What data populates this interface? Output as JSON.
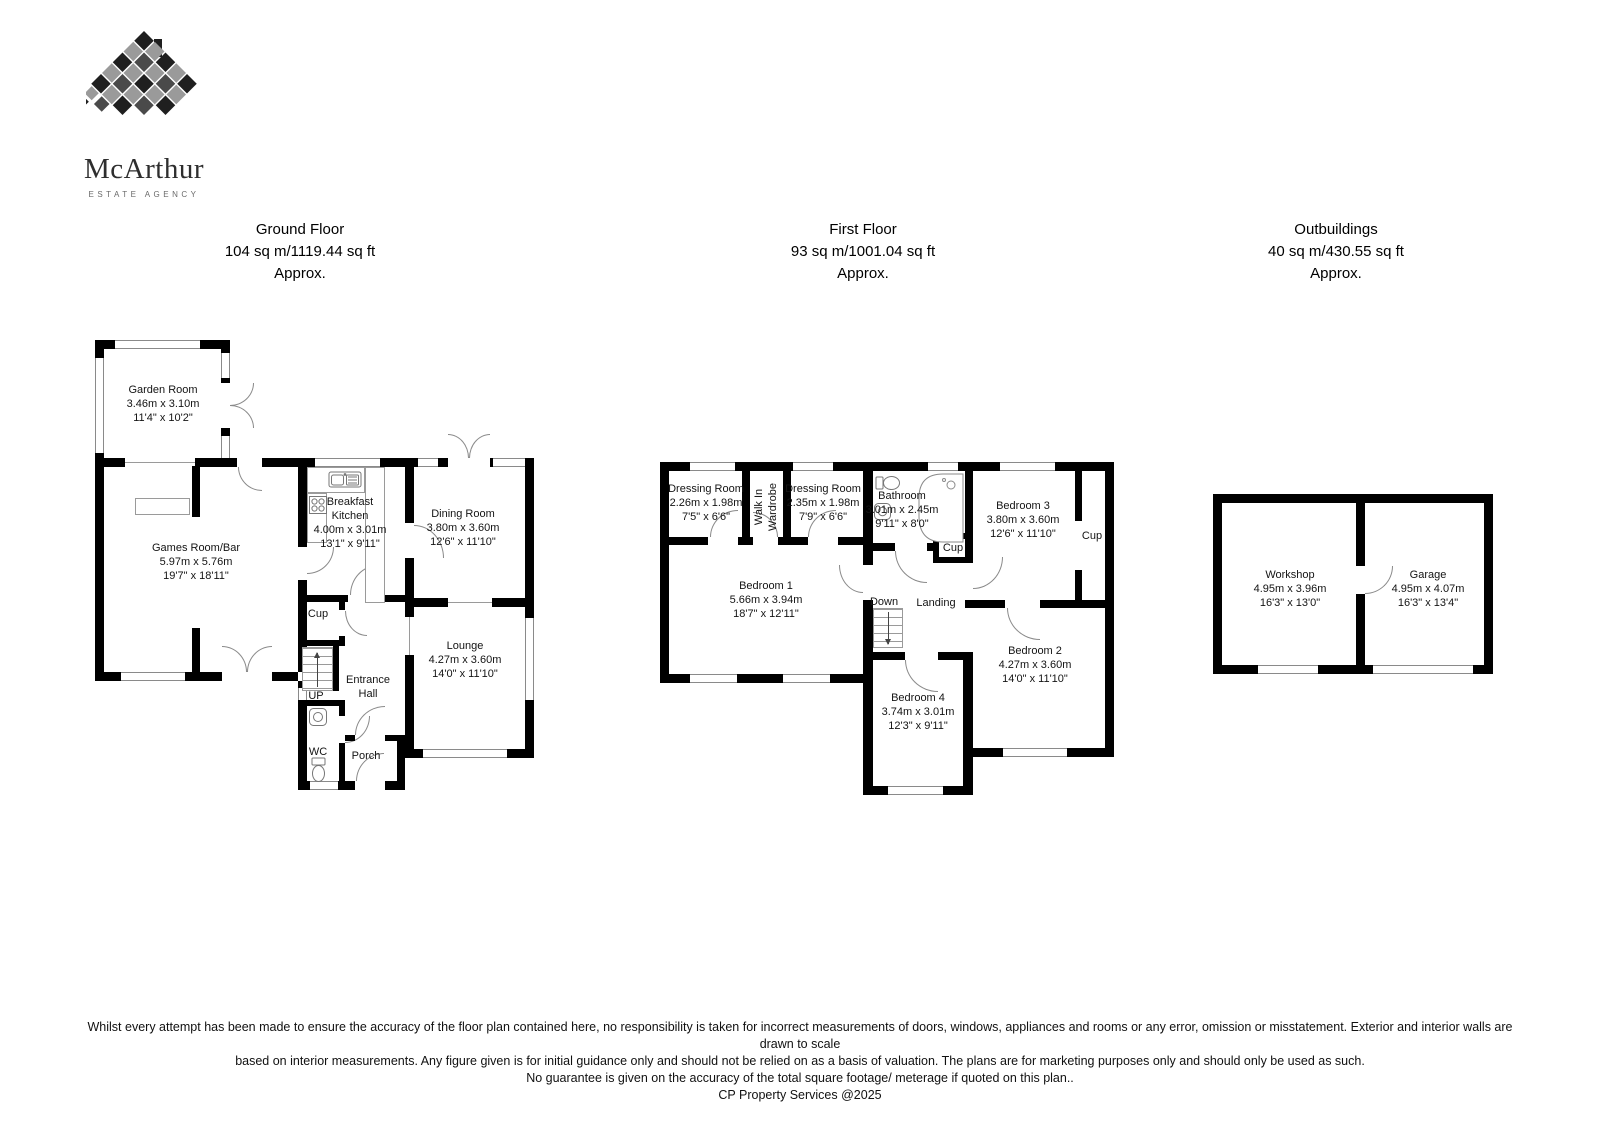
{
  "logo": {
    "brand": "McArthur",
    "tagline": "ESTATE AGENCY"
  },
  "sections": {
    "ground": {
      "title": "Ground Floor",
      "area": "104 sq m/1119.44 sq ft",
      "approx": "Approx."
    },
    "first": {
      "title": "First Floor",
      "area": "93 sq m/1001.04 sq ft",
      "approx": "Approx."
    },
    "out": {
      "title": "Outbuildings",
      "area": "40 sq m/430.55 sq ft",
      "approx": "Approx."
    }
  },
  "rooms": {
    "garden_room": {
      "name": "Garden Room",
      "metric": "3.46m x 3.10m",
      "imperial": "11'4\" x 10'2\""
    },
    "games_room": {
      "name": "Games Room/Bar",
      "metric": "5.97m x 5.76m",
      "imperial": "19'7\" x 18'11\""
    },
    "breakfast_kitchen": {
      "name": "Breakfast Kitchen",
      "metric": "4.00m x 3.01m",
      "imperial": "13'1\" x 9'11\""
    },
    "dining_room": {
      "name": "Dining Room",
      "metric": "3.80m x 3.60m",
      "imperial": "12'6\" x 11'10\""
    },
    "lounge": {
      "name": "Lounge",
      "metric": "4.27m x 3.60m",
      "imperial": "14'0\" x 11'10\""
    },
    "dressing_room_1": {
      "name": "Dressing Room",
      "metric": "2.26m x 1.98m",
      "imperial": "7'5\" x 6'6\""
    },
    "dressing_room_2": {
      "name": "Dressing Room",
      "metric": "2.35m x 1.98m",
      "imperial": "7'9\" x 6'6\""
    },
    "walk_in_wardrobe": {
      "name": "Walk In Wardrobe"
    },
    "bathroom": {
      "name": "Bathroom",
      "metric": "3.01m x 2.45m",
      "imperial": "9'11\" x 8'0\""
    },
    "bedroom_1": {
      "name": "Bedroom 1",
      "metric": "5.66m x 3.94m",
      "imperial": "18'7\" x 12'11\""
    },
    "bedroom_2": {
      "name": "Bedroom 2",
      "metric": "4.27m x 3.60m",
      "imperial": "14'0\" x 11'10\""
    },
    "bedroom_3": {
      "name": "Bedroom 3",
      "metric": "3.80m x 3.60m",
      "imperial": "12'6\" x 11'10\""
    },
    "bedroom_4": {
      "name": "Bedroom 4",
      "metric": "3.74m x 3.01m",
      "imperial": "12'3\" x 9'11\""
    },
    "workshop": {
      "name": "Workshop",
      "metric": "4.95m x 3.96m",
      "imperial": "16'3\" x 13'0\""
    },
    "garage": {
      "name": "Garage",
      "metric": "4.95m x 4.07m",
      "imperial": "16'3\" x 13'4\""
    }
  },
  "labels": {
    "cup": "Cup",
    "up": "UP",
    "down": "Down",
    "wc": "WC",
    "porch": "Porch",
    "entrance_hall": "Entrance Hall",
    "landing": "Landing"
  },
  "footer": {
    "line1": "Whilst every attempt has been made to ensure the accuracy of the floor plan contained here, no responsibility is taken for incorrect measurements of doors, windows, appliances and rooms or any error, omission or misstatement. Exterior and interior walls are drawn to scale",
    "line2": "based on interior measurements. Any figure given is for initial guidance only and should not be relied on as a basis of valuation. The plans are for marketing purposes only and should only be used as such.",
    "line3": "No guarantee is given on the accuracy of the total square footage/ meterage if quoted on this plan..",
    "credit": "CP Property Services @2025"
  },
  "colors": {
    "wall": "#000000",
    "line": "#8a8a8a",
    "text": "#1a1a1a"
  }
}
